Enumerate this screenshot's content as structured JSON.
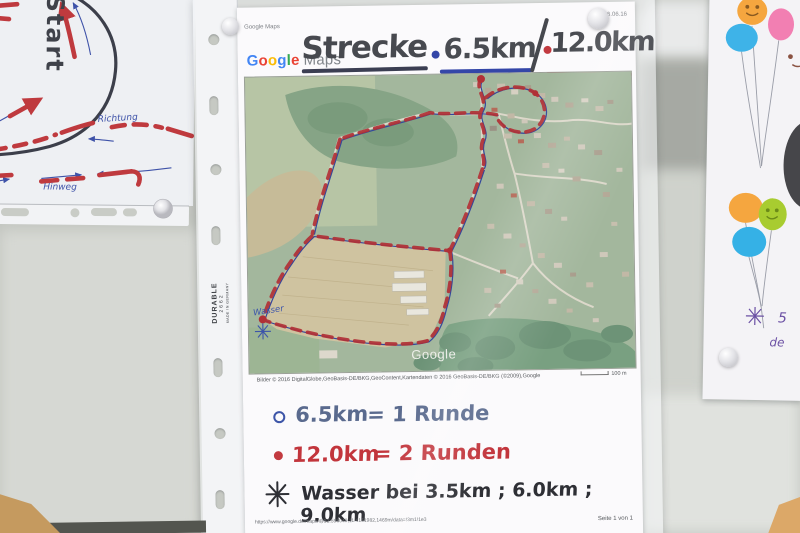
{
  "left_paper": {
    "start_label": "Start",
    "richtung_label": "Richtung",
    "hinweg_label": "Hinweg"
  },
  "center_page": {
    "print_header": {
      "left": "Google Maps",
      "right": "06.06.16"
    },
    "logo": {
      "google": "Google",
      "maps": "Maps"
    },
    "title": {
      "word": "Strecke",
      "distance_short": "6.5km",
      "distance_long": "12.0km"
    },
    "map": {
      "wasser_label": "Wasser",
      "watermark": "Google",
      "attribution": "Bilder © 2016 DigitalGlobe,GeoBasis-DE/BKG,GeoContent,Kartendaten © 2016 GeoBasis-DE/BKG (©2009),Google",
      "scale_label": "100 m"
    },
    "legend": {
      "line1": {
        "distance": "6.5km",
        "equals": "= 1 Runde"
      },
      "line2": {
        "distance": "12.0km",
        "equals": "= 2 Runden"
      },
      "line3": {
        "text": "Wasser bei 3.5km ; 6.0km ; 9.0km"
      }
    },
    "footer": {
      "url": "https://www.google.de/maps/@52.598049,11.4161982,1469m/data=!3m1!1e3",
      "page_label": "Seite 1 von 1"
    },
    "sleeve": {
      "brand": "DURABLE",
      "model": "2662",
      "origin": "MADE IN GERMANY"
    }
  },
  "right_paper": {
    "note_fragment_1": "5",
    "note_fragment_2": "de"
  }
}
